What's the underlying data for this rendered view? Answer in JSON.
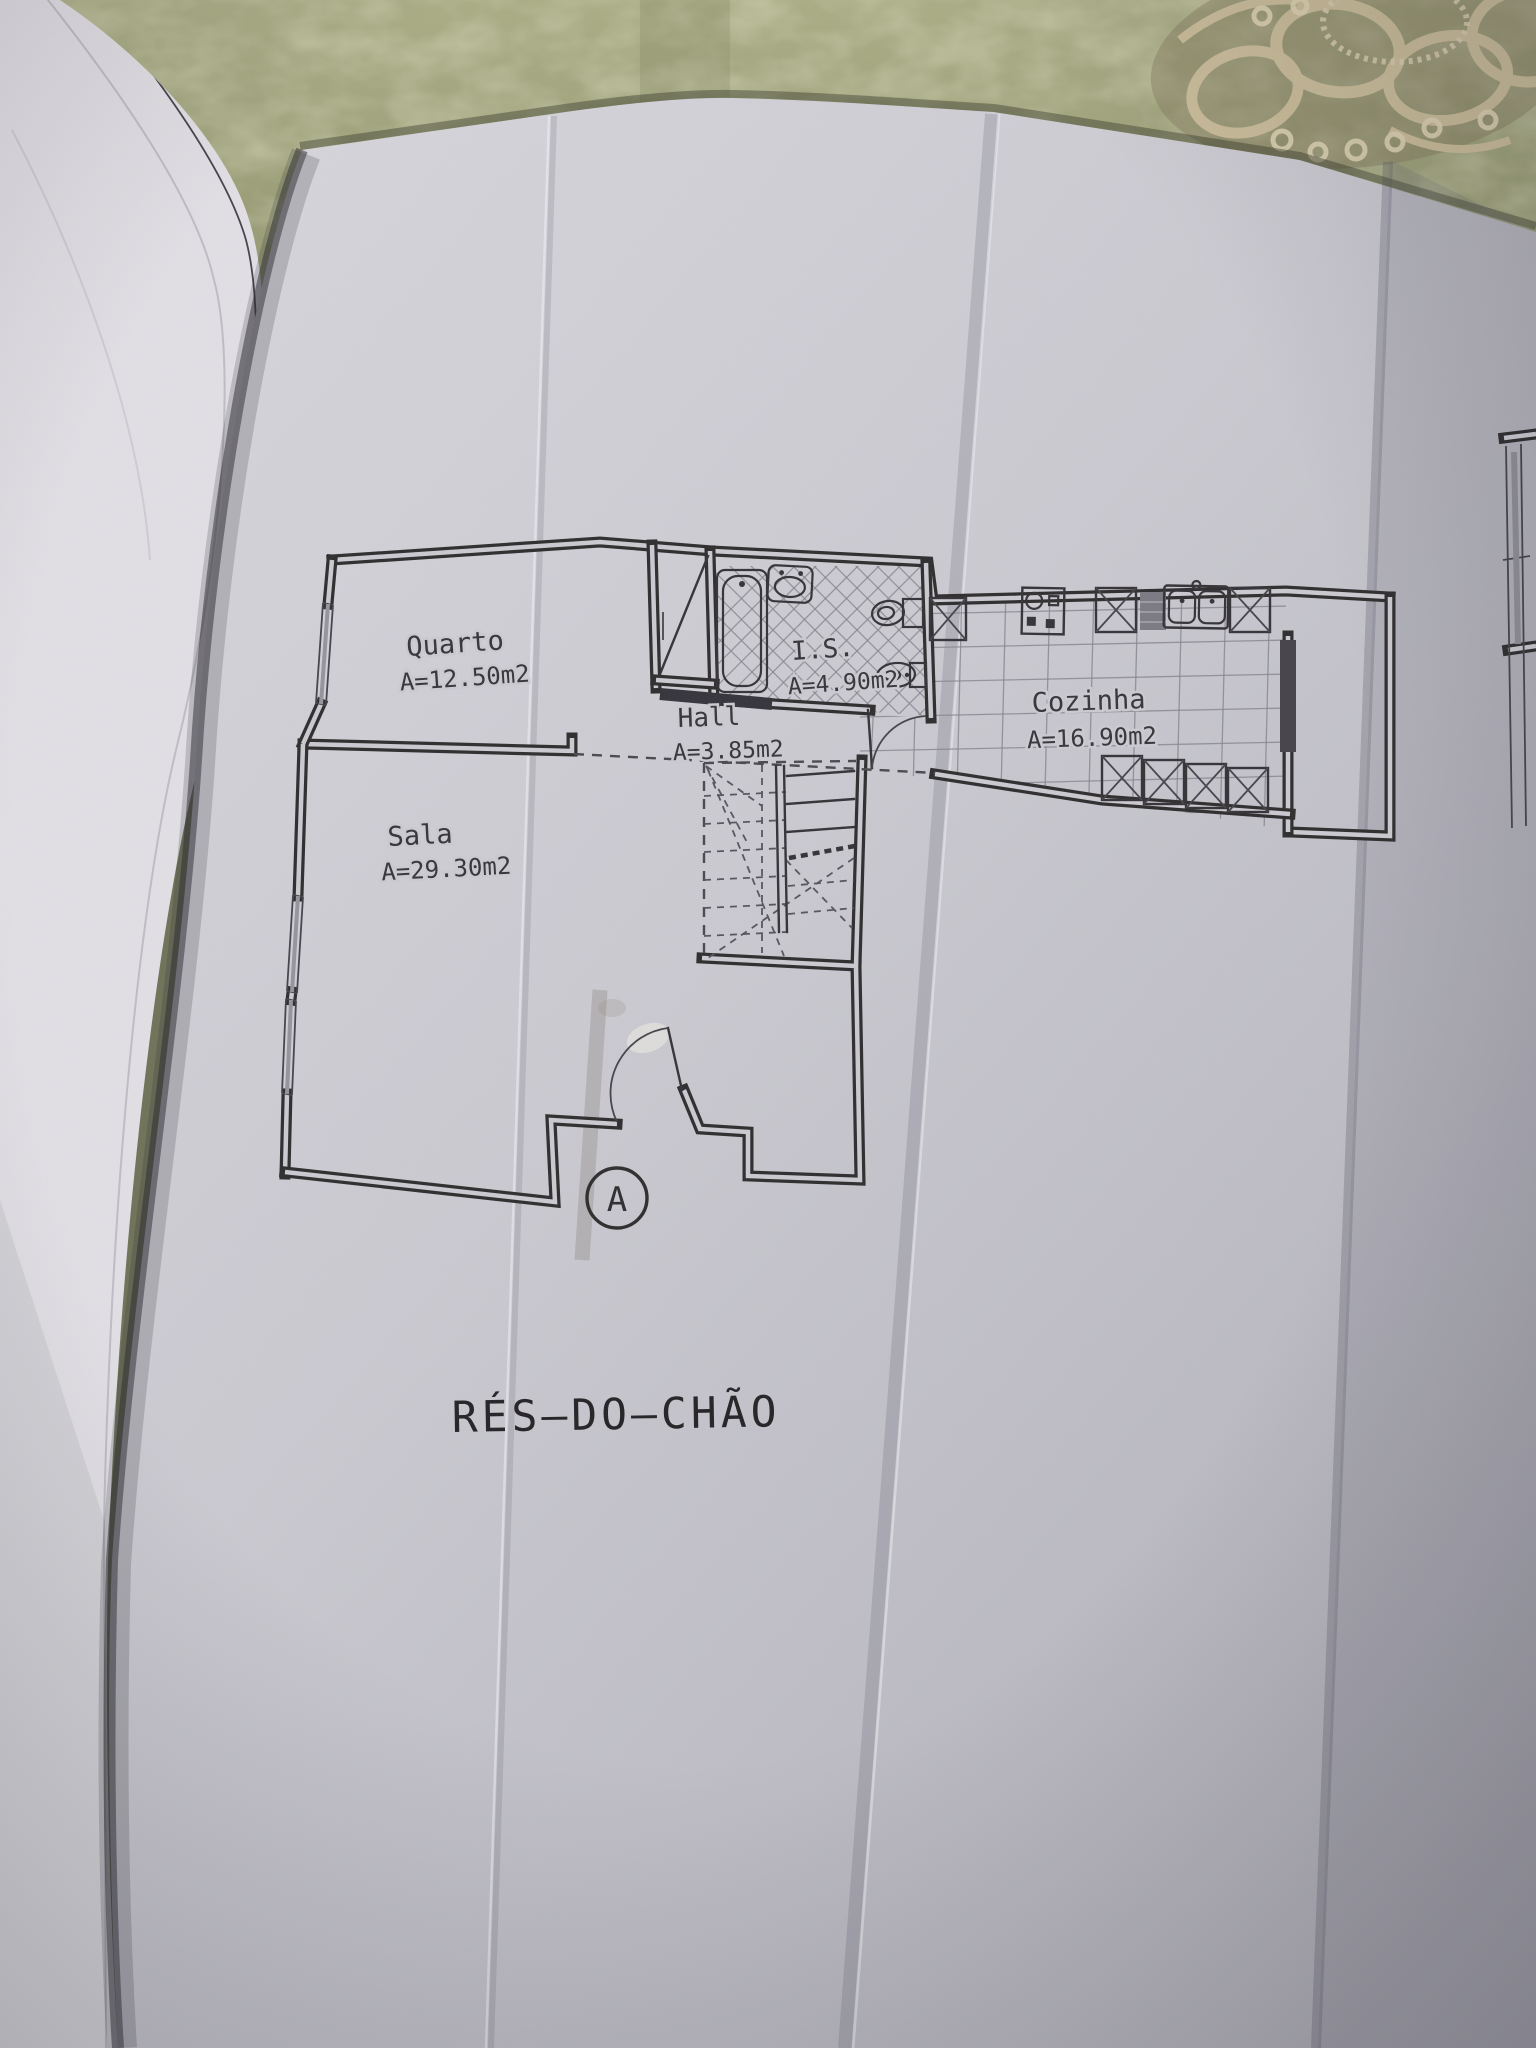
{
  "document": {
    "kind": "architectural floor plan photograph",
    "floor_title": "RÉS—DO—CHÃO",
    "section_marker": "A",
    "rooms": [
      {
        "name": "Quarto",
        "area": "A=12.50m2"
      },
      {
        "name": "Sala",
        "area": "A=29.30m2"
      },
      {
        "name": "Hall",
        "area": "A=3.85m2"
      },
      {
        "name": "I.S.",
        "area": "A=4.90m2"
      },
      {
        "name": "Cozinha",
        "area": "A=16.90m2"
      }
    ],
    "colors": {
      "paper": "#cbcad1",
      "ink": "#2e2c2d",
      "tile_line": "#84838c",
      "tablecloth": "#9da177",
      "doily": "#cdbf9c",
      "page_stack": "#e2e0e5"
    }
  }
}
